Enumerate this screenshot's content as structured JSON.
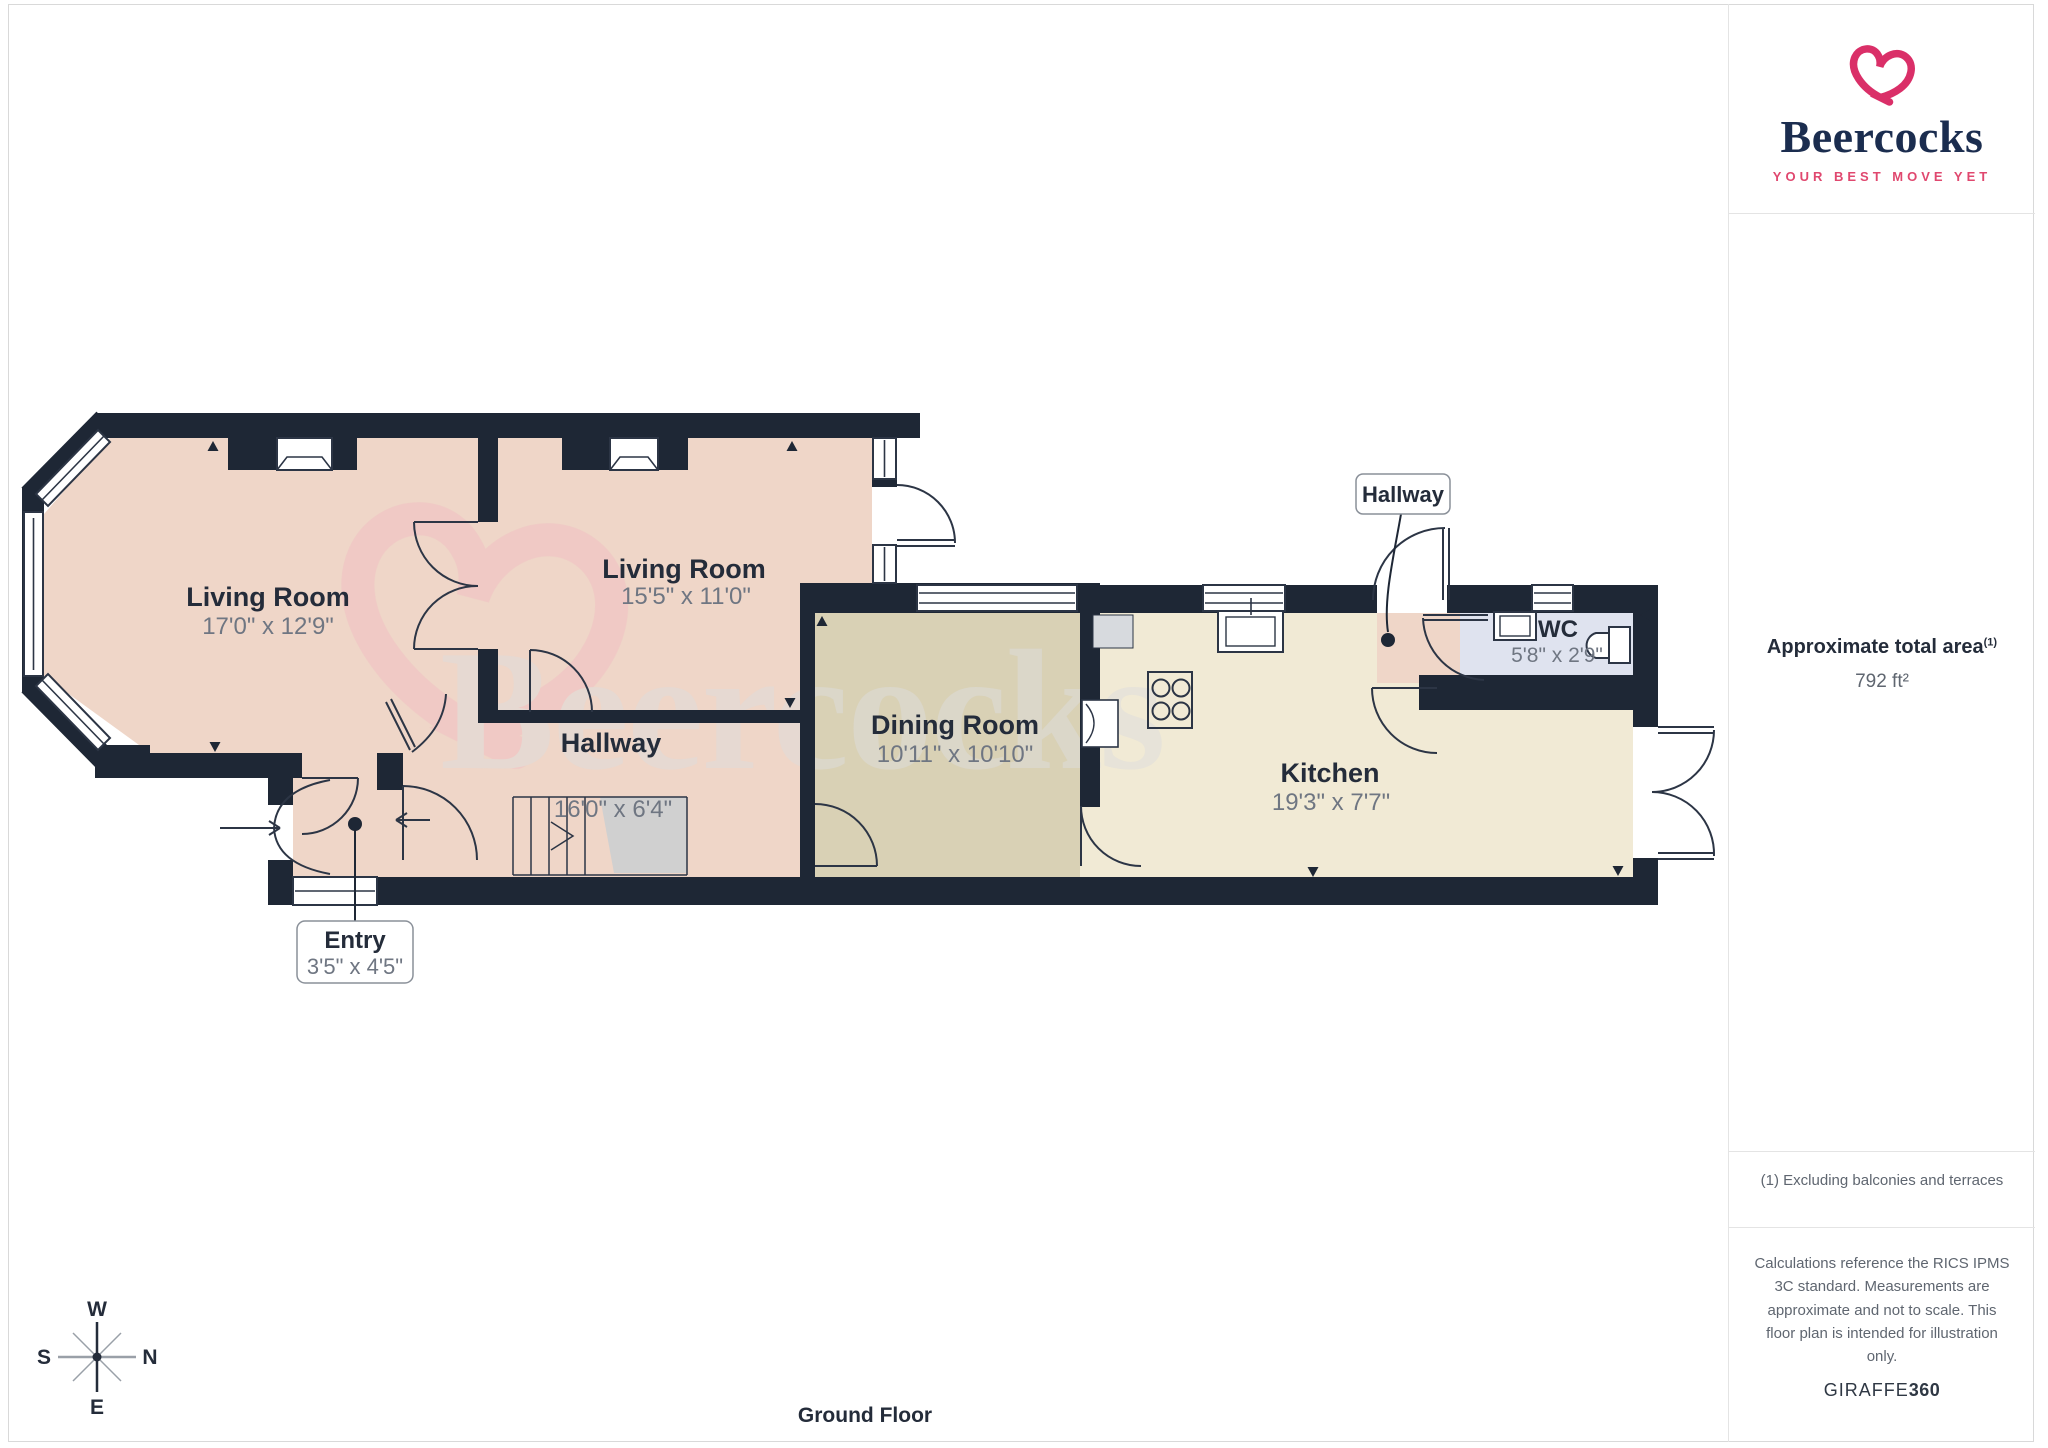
{
  "branding": {
    "name": "Beercocks",
    "tagline": "YOUR BEST MOVE YET",
    "heart_icon": "heart-swirl",
    "pink": "#da2f68",
    "navy": "#1b2d4f"
  },
  "sidebar": {
    "area_title": "Approximate total area",
    "area_footnote_marker": "(1)",
    "area_value": "792 ft²",
    "footnote": "(1) Excluding balconies and terraces",
    "disclaimer": "Calculations reference the RICS IPMS 3C standard. Measurements are approximate and not to scale. This floor plan is intended for illustration only.",
    "provider": "GIRAFFE",
    "provider_bold": "360"
  },
  "plan": {
    "floor_label": "Ground Floor",
    "watermark": "Beercocks",
    "rooms": [
      {
        "name": "Living Room",
        "dimensions": "17'0\" x 12'9\""
      },
      {
        "name": "Living Room",
        "dimensions": "15'5\" x 11'0\""
      },
      {
        "name": "Hallway",
        "dimensions": "16'0\" x 6'4\""
      },
      {
        "name": "Dining Room",
        "dimensions": "10'11\" x 10'10\""
      },
      {
        "name": "Kitchen",
        "dimensions": "19'3\" x 7'7\""
      },
      {
        "name": "WC",
        "dimensions": "5'8\" x 2'9\""
      }
    ],
    "callouts": {
      "entry": {
        "label": "Entry",
        "dimensions": "3'5\" x 4'5\""
      },
      "hallway": {
        "label": "Hallway"
      }
    },
    "compass": {
      "top": "W",
      "left": "S",
      "right": "N",
      "bottom": "E"
    },
    "colors": {
      "wall": "#1e2735",
      "living": "#efd6c8",
      "dining": "#d9d1b5",
      "kitchen": "#f1ead5",
      "wc": "#dfe3ef"
    }
  }
}
